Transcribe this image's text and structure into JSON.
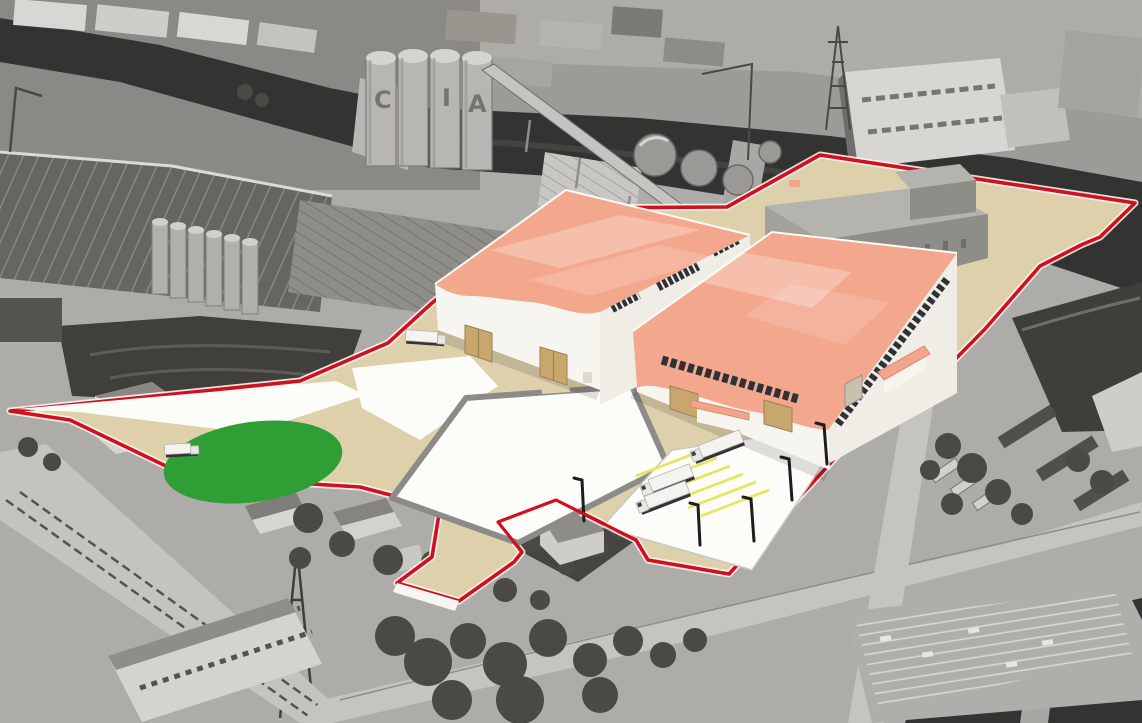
{
  "scene": {
    "kind": "aerial-3d-masterplan-rendering",
    "description": "Oblique grayscale aerial photograph of a riverside industrial district with a colored 3D redevelopment overlay: red site boundary, beige hardstanding, two proposed salmon-roofed warehouses, white paved yards, green landscaped oval and truck parking bays.",
    "base_layer": "grayscale aerial photo",
    "overlay_layer": "colored 3D site plan"
  },
  "colors": {
    "boundary_red": "#d20f1e",
    "curb_white": "#f6f5f1",
    "ground_beige": "#ddd0ab",
    "roof_salmon": "#f3a78d",
    "roof_stripe": "#f9c3ac",
    "wall_white": "#f7f5f0",
    "wall_shaded": "#efede5",
    "window_band": "#2e3236",
    "door_tan": "#c8a76e",
    "green_area": "#2f9e35",
    "pad_white": "#fcfcf9",
    "yard_wall_gray": "#8d8b88",
    "stripe_yellow": "#e8e45c",
    "existing_roof_gray": "#b5b3ae",
    "existing_front_gray": "#a3a19c",
    "existing_side_gray": "#8f8d88",
    "canopy_salmon": "#f2a48c",
    "truck_white": "#f4f3f0",
    "lamp_black": "#1d1d1d",
    "water_dark": "#333431",
    "photo_light": "#c9c7c3",
    "photo_mid": "#8f8d89",
    "photo_dark": "#3b3a38",
    "tree_dark": "#4a4944"
  },
  "site_plan": {
    "boundary_style": "solid red line with white curb edge",
    "boundary_shape": "irregular polygon: pointed west tip, straight waterfront top edge, stepped zigzag east edge, notched house plot and access tongue on the south edge",
    "features": [
      {
        "id": "warehouse-west",
        "kind": "proposed warehouse",
        "roof": "salmon with wavy eave",
        "walls": "white",
        "tan_double_doors": 2,
        "window_bands": 3
      },
      {
        "id": "warehouse-east",
        "kind": "proposed warehouse (larger)",
        "roof": "salmon with wavy eave",
        "walls": "white",
        "window_bands": 2,
        "loading_canopies": 2,
        "tan_doors": 2
      },
      {
        "id": "existing-massing",
        "kind": "retained building massing model",
        "color": "gray"
      },
      {
        "id": "walled-yard",
        "kind": "white paved yard enclosed by gray perimeter wall with north gate opening"
      },
      {
        "id": "west-wedge",
        "kind": "white paved wedge tapering to the west tip"
      },
      {
        "id": "green-area",
        "kind": "landscaped green oval"
      },
      {
        "id": "truck-park",
        "kind": "white pad with yellow parking bays",
        "bays": 6,
        "parked_trucks": 3
      },
      {
        "id": "south-driveway",
        "kind": "beige access tongue to the south road"
      },
      {
        "id": "excluded-house",
        "kind": "retained house plot notched out of the site, outlined in red"
      },
      {
        "id": "lamp-posts",
        "count": 5
      }
    ]
  },
  "vehicles": {
    "white_trucks_total": 5,
    "parked_in_bays": 3,
    "at_west_warehouse": 1,
    "at_green_area": 1,
    "grayscale_photo_trucks_east": 3
  },
  "photo": {
    "silo_letters": [
      "C",
      "I",
      "A"
    ],
    "landmarks": [
      "dark river across the top with two bridges",
      "tall grain silos with painted letters",
      "round storage tanks",
      "electricity pylons",
      "large ribbed factory roofs upper-left",
      "white shipyard building upper-right",
      "tree clusters along the south",
      "striped car park bottom-right",
      "road and rail line bottom-left"
    ]
  }
}
